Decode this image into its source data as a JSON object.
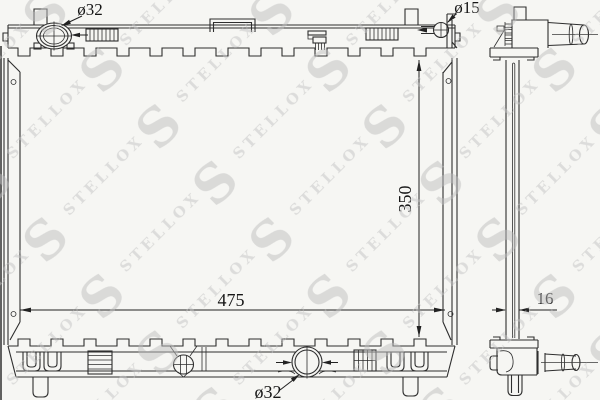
{
  "watermark": {
    "monogram": "S",
    "brand": "STELLOX"
  },
  "dimensions": {
    "filler_neck_diameter": "ø32",
    "overflow_pipe_diameter": "ø15",
    "core_height_mm": "350",
    "core_width_mm": "475",
    "core_depth_mm": "16",
    "outlet_diameter": "ø32"
  }
}
